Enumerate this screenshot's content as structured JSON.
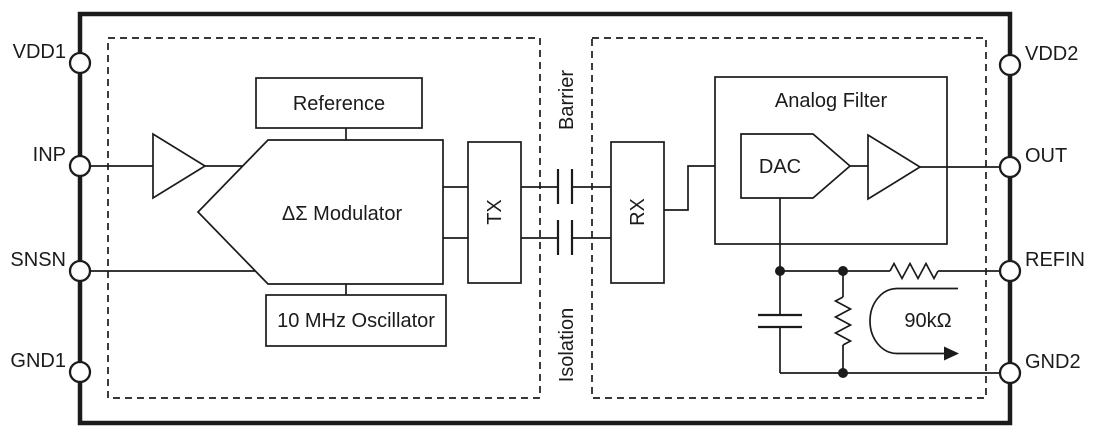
{
  "pins": {
    "left": [
      {
        "id": "vdd1",
        "label": "VDD1"
      },
      {
        "id": "inp",
        "label": "INP"
      },
      {
        "id": "snsn",
        "label": "SNSN"
      },
      {
        "id": "gnd1",
        "label": "GND1"
      }
    ],
    "right": [
      {
        "id": "vdd2",
        "label": "VDD2"
      },
      {
        "id": "out",
        "label": "OUT"
      },
      {
        "id": "refin",
        "label": "REFIN"
      },
      {
        "id": "gnd2",
        "label": "GND2"
      }
    ]
  },
  "blocks": {
    "reference": {
      "label": "Reference"
    },
    "modulator": {
      "label": "ΔΣ Modulator"
    },
    "oscillator": {
      "label": "10 MHz Oscillator"
    },
    "tx": {
      "label": "TX"
    },
    "rx": {
      "label": "RX"
    },
    "analog_filter": {
      "label": "Analog Filter"
    },
    "dac": {
      "label": "DAC"
    }
  },
  "labels": {
    "barrier": "Barrier",
    "isolation": "Isolation",
    "resistance": "90kΩ"
  },
  "colors": {
    "line": "#1b1b1b",
    "background": "#ffffff"
  }
}
